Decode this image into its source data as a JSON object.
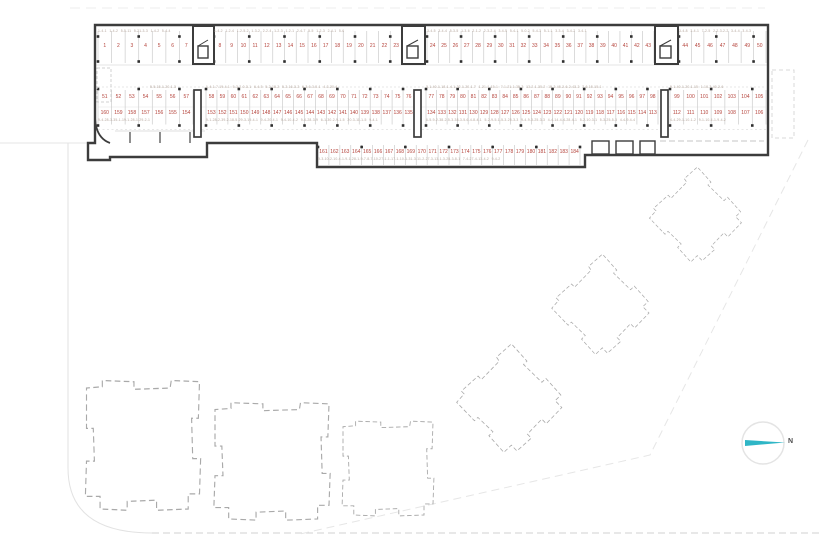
{
  "title": "parking-level site plan",
  "colors": {
    "wall": "#3c3c3c",
    "stall_number": "#b5443c",
    "unit_code": "#b6a79d",
    "tick": "#cccccc",
    "building_dash": "#a9a9a9",
    "site_line": "#e2e2e2",
    "north_arrow": "#2fb6c6"
  },
  "north": {
    "label": "N"
  },
  "parking": {
    "row_top": {
      "groups": [
        [
          1,
          2,
          3,
          4,
          5,
          6,
          7
        ],
        [
          8,
          9,
          10,
          11,
          12,
          13,
          14,
          15,
          16,
          17,
          18,
          19,
          20,
          21,
          22,
          23
        ],
        [
          24,
          25,
          26,
          27,
          28,
          29,
          30,
          31,
          32,
          33,
          34,
          35,
          36,
          37,
          38,
          39,
          40,
          41,
          42,
          43
        ],
        [
          44,
          45,
          46,
          47,
          48,
          49,
          50
        ]
      ]
    },
    "row_mid_upper": {
      "groups": [
        [
          51,
          52,
          53,
          54,
          55,
          56,
          57
        ],
        [
          58,
          59,
          60,
          61,
          62,
          63,
          64,
          65,
          66,
          67,
          68,
          69,
          70,
          71,
          72,
          73,
          74,
          75,
          76
        ],
        [
          77,
          78,
          79,
          80,
          81,
          82,
          83,
          84,
          85,
          86,
          87,
          88,
          89,
          90,
          91,
          92,
          93,
          94,
          95,
          96,
          97,
          98
        ],
        [
          99,
          100,
          101,
          102,
          103,
          104,
          105
        ]
      ]
    },
    "row_mid_lower": {
      "groups": [
        [
          160,
          159,
          158,
          157,
          156,
          155,
          154
        ],
        [
          153,
          152,
          151,
          150,
          149,
          148,
          147,
          146,
          145,
          144,
          143,
          142,
          141,
          140,
          139,
          138,
          137,
          136,
          135
        ],
        [
          134,
          133,
          132,
          131,
          130,
          129,
          128,
          127,
          126,
          125,
          124,
          123,
          122,
          121,
          120,
          119,
          118,
          117,
          116,
          115,
          114,
          113
        ],
        [
          112,
          111,
          110,
          109,
          108,
          107,
          106
        ]
      ]
    },
    "row_bottom": {
      "groups": [
        [
          161,
          162,
          163,
          164,
          165,
          166,
          167,
          168,
          169,
          170,
          171,
          172,
          173,
          174,
          175,
          176,
          177,
          178,
          179,
          180,
          181,
          182,
          183,
          184
        ]
      ]
    }
  },
  "unit_codes": {
    "a1": "1-4-1 1-4-2 5-5-11 5-21-3-3 1-4-2 5-4-4",
    "a2": "1-4-2 1-2-4 1-2-5-2 1-3-2 2-2-4 1-2-3 1-2-1 2-4-7 5-5 1-2-3 2-4-1 5-6",
    "a3": "3-4-5 3-4-4 5-3-5 1-3-6 2-1-2 2-3-2-4 3-4-5 5-4-1 5-0-2 5-4-3 5-1-1 3-3-4 3-4-2 3-4-1",
    "a4": "3-4-8 3-4-1 7-2-5 2-2-3-2-2 3-4-4 3-4-3",
    "b1": "5-5-15-1-20-1-3",
    "b2": "1-4-1-7-19-4-1 5-3-2-0-3-1 6-4-5 5-2-18-2 5-2-16-3-2 6-3-6-3-5-1 4-3-20-4",
    "b3": "3-1-40-1-18-1-4-1-32-1-20-1-7 1-21-1-15-1 7-1-21-1-35-2 13-2-1-35-2 15-2-45-2-6-2-43-2 7-6-15-15-1",
    "b4": "9-1-40-1-20-1-15 1-10-2-40-2-6",
    "c1": "9-4-28-3-35-1-19-1-28-1-29-2-1",
    "c2": "9-1-28-2-39-2-18-5-29-3-19-4-1 9-4-20-4-1 9-4-10-4-2 9-4-28-3-9 6-1-30-2-9-1-5 20-3-11-1-5 9-4-1",
    "c3": "6-5-9-2-38-2-5-3-38-3-5-6-4-8-4-1 5-2-9-5-1-5-3-25-3-3 9-4-9-3-25-3-3 4-4-14-4-4-28-4-1 5-2-10-3-1 5-3-25-5-3 4-4-9-4-4",
    "c4": "4-4-29-1-10-1-2 9-1-10-4-1-9-4-2",
    "d1": "9-3-10-2-10-4-1-9-1-28-1-9-7-8-7-10-27-1-1-17-1-10-1-31-3-11-2-27-3-13-1-3-28-3-8-1 7-4-27-4-13-4-2 9-4-2"
  }
}
